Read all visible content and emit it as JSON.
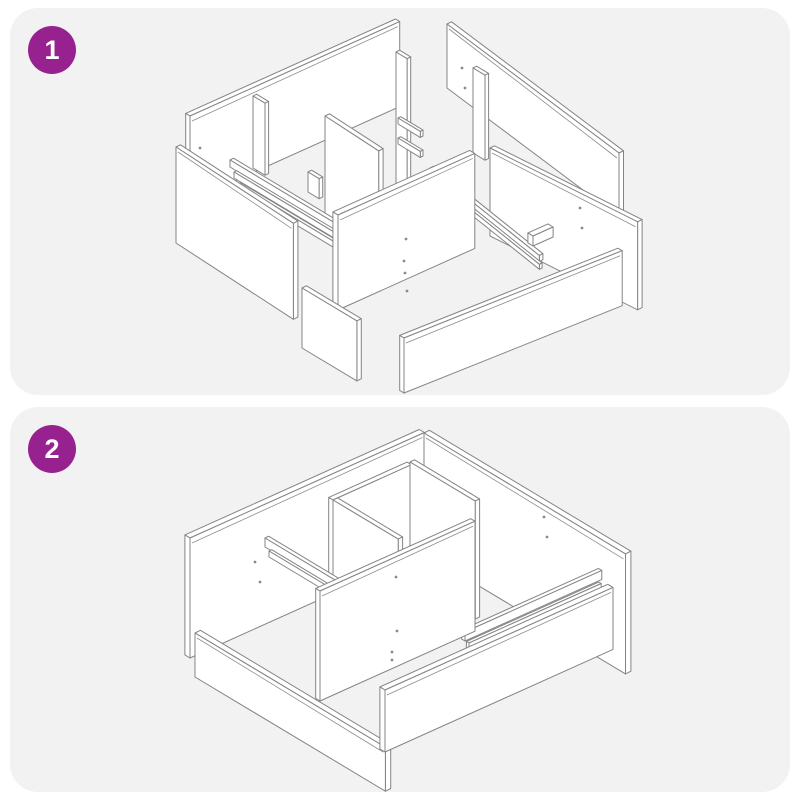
{
  "document": {
    "kind": "assembly-instruction-sheet",
    "background": "#ffffff"
  },
  "steps": [
    {
      "number": "1",
      "illustration": "exploded-parts-isometric-drawing"
    },
    {
      "number": "2",
      "illustration": "partially-assembled-frame-isometric-drawing"
    }
  ],
  "colors": {
    "step_badge": "#96218f",
    "badge_text": "#ffffff",
    "card_background": "#f2f2f2",
    "drawing_line": "#848484",
    "panel_face": "#ffffff"
  }
}
